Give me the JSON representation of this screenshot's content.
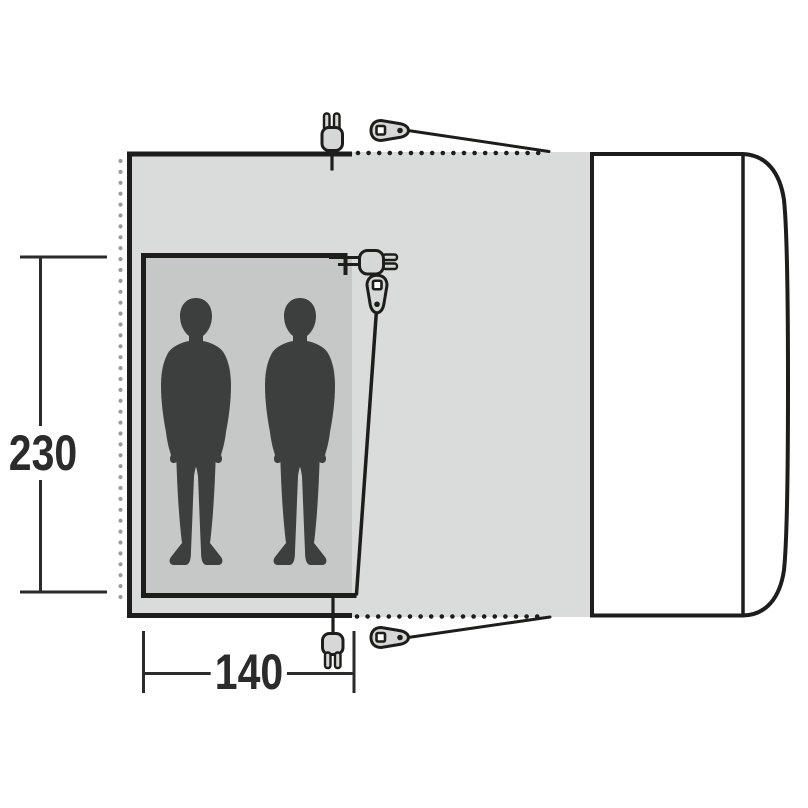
{
  "diagram": {
    "dimensions": {
      "depth_cm": "230",
      "width_cm": "140"
    },
    "sleeping_area": {
      "person_silhouettes": 2
    },
    "icons": {
      "power_plug": "power-plug-icon",
      "guyline_runner": "guyline-runner-icon"
    },
    "colors": {
      "outline": "#1d1d1b",
      "tent_floor": "#dadbdb",
      "inner_tent": "#c6c7c7",
      "silhouette": "#3d3e3e",
      "icon_fill": "#d6d7d7",
      "edge_dots_gray": "#9c9c9c",
      "dimension_text": "#2b2b2b",
      "vehicle_fill": "#ffffff",
      "background": "#ffffff"
    }
  }
}
